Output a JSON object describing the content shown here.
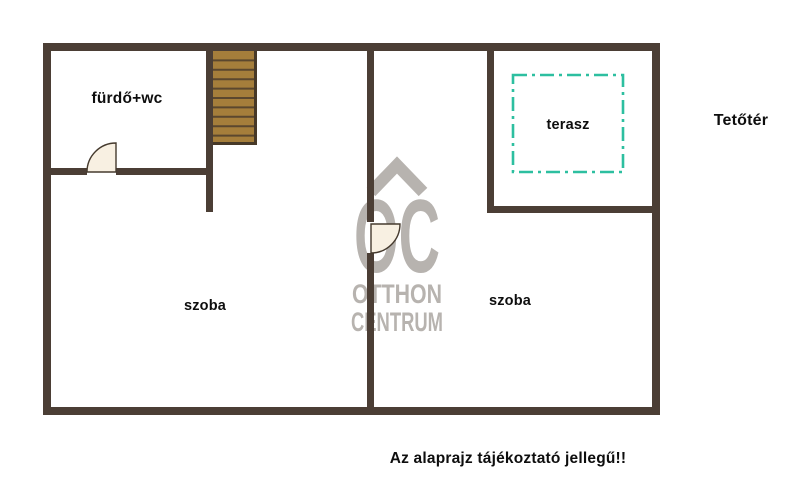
{
  "plan": {
    "labels": {
      "bathroom": "fürdő+wc",
      "terrace": "terasz",
      "room_left": "szoba",
      "room_right": "szoba",
      "attic": "Tetőtér"
    },
    "note": "Az alaprajz tájékoztató jellegű!!"
  },
  "watermark": {
    "monogram": "OC",
    "line1": "OTTHON",
    "line2": "CENTRUM"
  },
  "colors": {
    "background": "#ffffff",
    "wall": "#4b3e35",
    "stair_wood": "#a57e3b",
    "stair_divider": "#5b472e",
    "stair_border": "#473928",
    "terrace_dash": "#2dbfa0",
    "door_fill": "#f8f0e2",
    "door_stroke": "#453a2e",
    "watermark": "#b7b3af",
    "label": "#0e0e0e"
  }
}
